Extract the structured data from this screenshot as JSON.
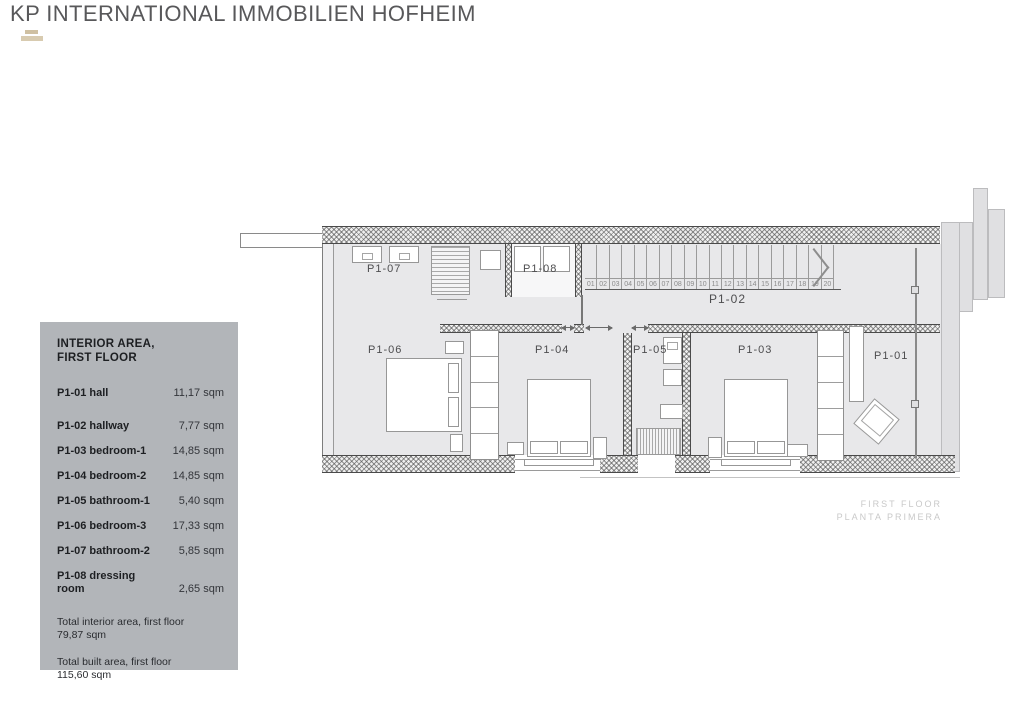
{
  "header": {
    "title": "KP INTERNATIONAL IMMOBILIEN HOFHEIM"
  },
  "legend": {
    "title_line1": "INTERIOR AREA,",
    "title_line2": "FIRST FLOOR",
    "rows": [
      {
        "label": "P1-01 hall",
        "value": "11,17 sqm"
      },
      {
        "label": "P1-02 hallway",
        "value": "7,77 sqm"
      },
      {
        "label": "P1-03 bedroom-1",
        "value": "14,85 sqm"
      },
      {
        "label": "P1-04 bedroom-2",
        "value": "14,85 sqm"
      },
      {
        "label": "P1-05 bathroom-1",
        "value": "5,40 sqm"
      },
      {
        "label": "P1-06 bedroom-3",
        "value": "17,33 sqm"
      },
      {
        "label": "P1-07 bathroom-2",
        "value": "5,85 sqm"
      },
      {
        "label": "P1-08 dressing room",
        "value": "2,65 sqm"
      }
    ],
    "totals": [
      {
        "label": "Total interior area, first floor",
        "value": "79,87 sqm"
      },
      {
        "label": "Total built area, first floor",
        "value": "115,60 sqm"
      }
    ]
  },
  "plan": {
    "rooms": {
      "p101": "P1-01",
      "p102": "P1-02",
      "p103": "P1-03",
      "p104": "P1-04",
      "p105": "P1-05",
      "p106": "P1-06",
      "p107": "P1-07",
      "p108": "P1-08"
    },
    "stairs": {
      "steps": [
        "01",
        "02",
        "03",
        "04",
        "05",
        "06",
        "07",
        "08",
        "09",
        "10",
        "11",
        "12",
        "13",
        "14",
        "15",
        "16",
        "17",
        "18",
        "19",
        "20"
      ]
    },
    "caption_line1": "FIRST FLOOR",
    "caption_line2": "PLANTA PRIMERA"
  },
  "colors": {
    "legend_bg": "#b2b5b9",
    "floor": "#e8e8ea",
    "wall": "#4a4a4a",
    "header_text": "#58585a",
    "caption_text": "#c9c9c9",
    "logo_tan": "#cfc0a2"
  }
}
